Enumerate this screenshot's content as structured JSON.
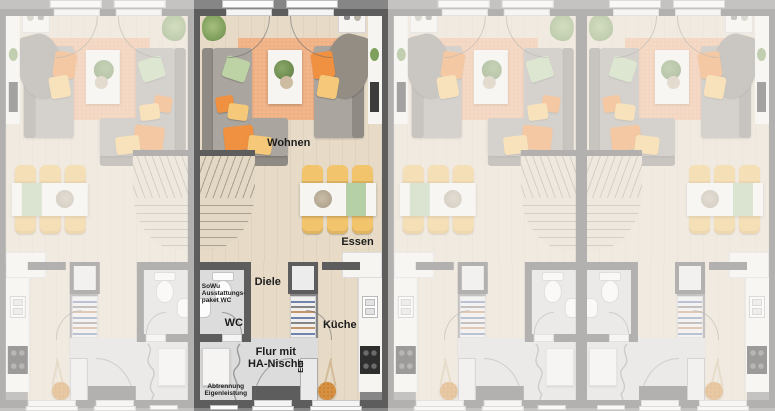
{
  "scene": {
    "type": "townhouse-floorplan-row",
    "units": [
      {
        "name": "unit-1",
        "mirrored": true,
        "dimmed": true,
        "labeled": false
      },
      {
        "name": "unit-2",
        "mirrored": false,
        "dimmed": false,
        "labeled": true
      },
      {
        "name": "unit-3",
        "mirrored": true,
        "dimmed": true,
        "labeled": false
      },
      {
        "name": "unit-4",
        "mirrored": false,
        "dimmed": true,
        "labeled": false
      }
    ]
  },
  "labels": {
    "wohnen": "Wohnen",
    "essen": "Essen",
    "diele": "Diele",
    "wc": "WC",
    "kueche": "Küche",
    "flur": "Flur mit\nHA-Nische",
    "elt": "ELT",
    "sowu_note": "SoWu\nAusstattungs-\npaket WC",
    "abtrennung_note": "Abtrennung\nEigenleistung"
  },
  "colors": {
    "wall": "#5d5d5d",
    "outside": "#868686",
    "floor-wood": "#e7dbc8",
    "floor-tile": "#dcdcdc",
    "rug": "#f0b185",
    "sofa": "#aaa59e",
    "sofa-dark": "#8f8a83",
    "drape": "#938d84",
    "counter": "#f6f5f2",
    "chair-yellow": "#f2c46c",
    "runner-green": "#b5cfa6",
    "pillow-green": "#bdd3a6",
    "pillow-orange": "#ef9140",
    "pillow-yellow": "#f5c979",
    "stove": "#2e2e2e",
    "stairs": "#e3d8c5",
    "deco-orange": "#d6903f",
    "text": "#1c1c1c"
  }
}
